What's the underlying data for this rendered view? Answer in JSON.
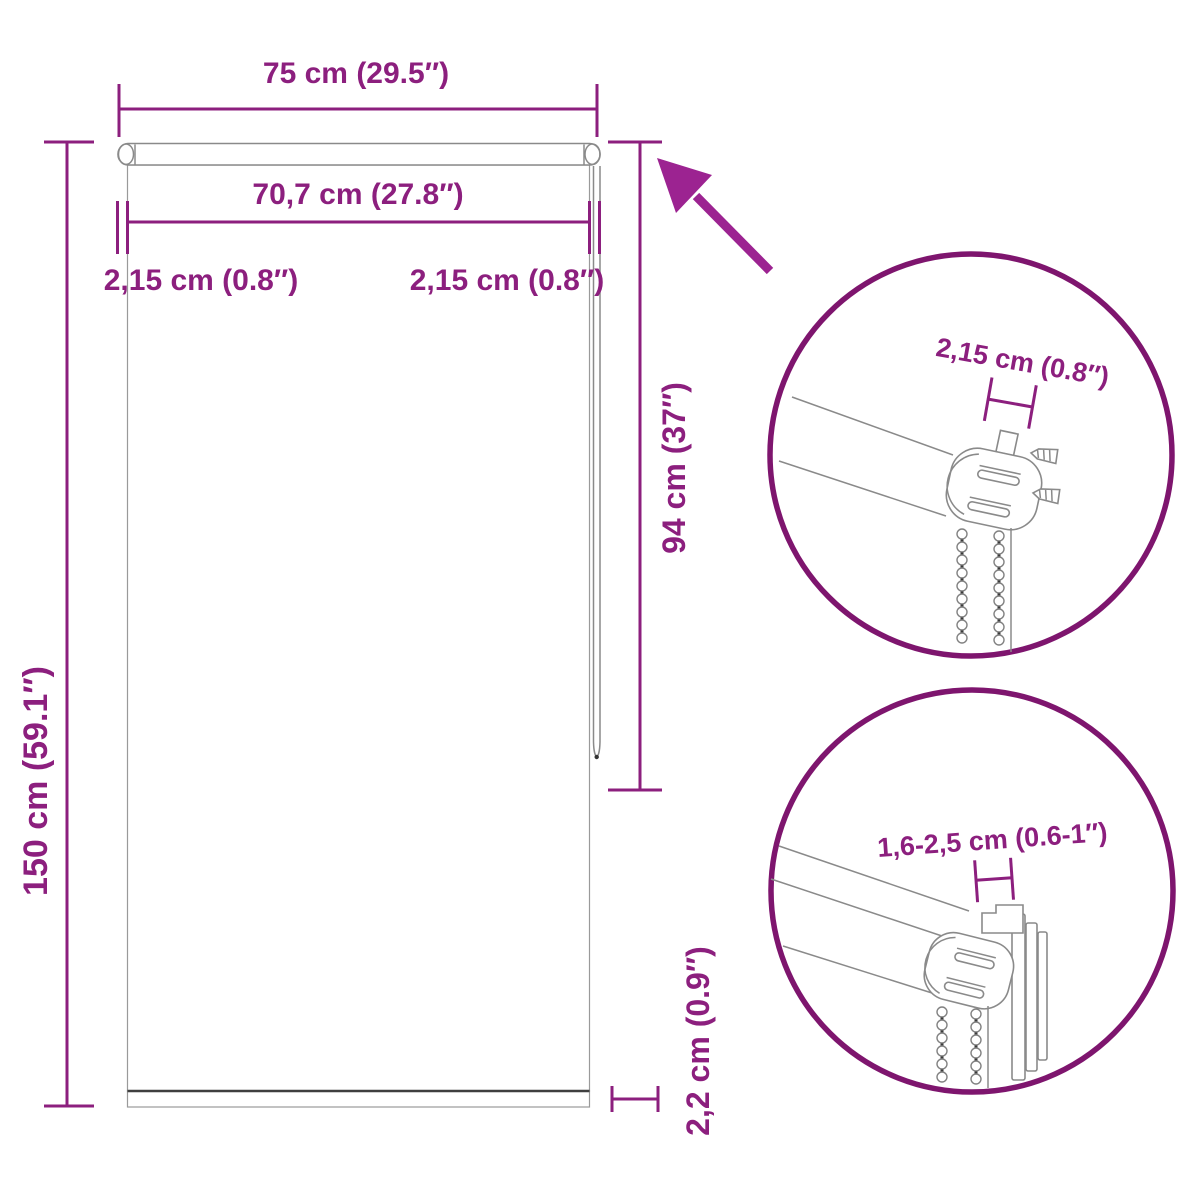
{
  "title": "Roller blind dimension diagram",
  "colors": {
    "accent": "#8c1f7e",
    "arrow": "#9c2391",
    "circle": "#7e156e",
    "line": "#8a8a8a",
    "dark": "#3f3f3f"
  },
  "dimensions": {
    "total_width": "75 cm (29.5″)",
    "fabric_width": "70,7 cm (27.8″)",
    "side_offset_left": "2,15 cm (0.8″)",
    "side_offset_right": "2,15 cm (0.8″)",
    "total_height": "150 cm (59.1″)",
    "chain_length": "94 cm (37″)",
    "bottom_bar_height": "2,2 cm (0.9″)"
  },
  "details": {
    "top_circle_dimension": "2,15 cm (0.8″)",
    "bottom_circle_dimension": "1,6-2,5 cm (0.6-1″)"
  }
}
